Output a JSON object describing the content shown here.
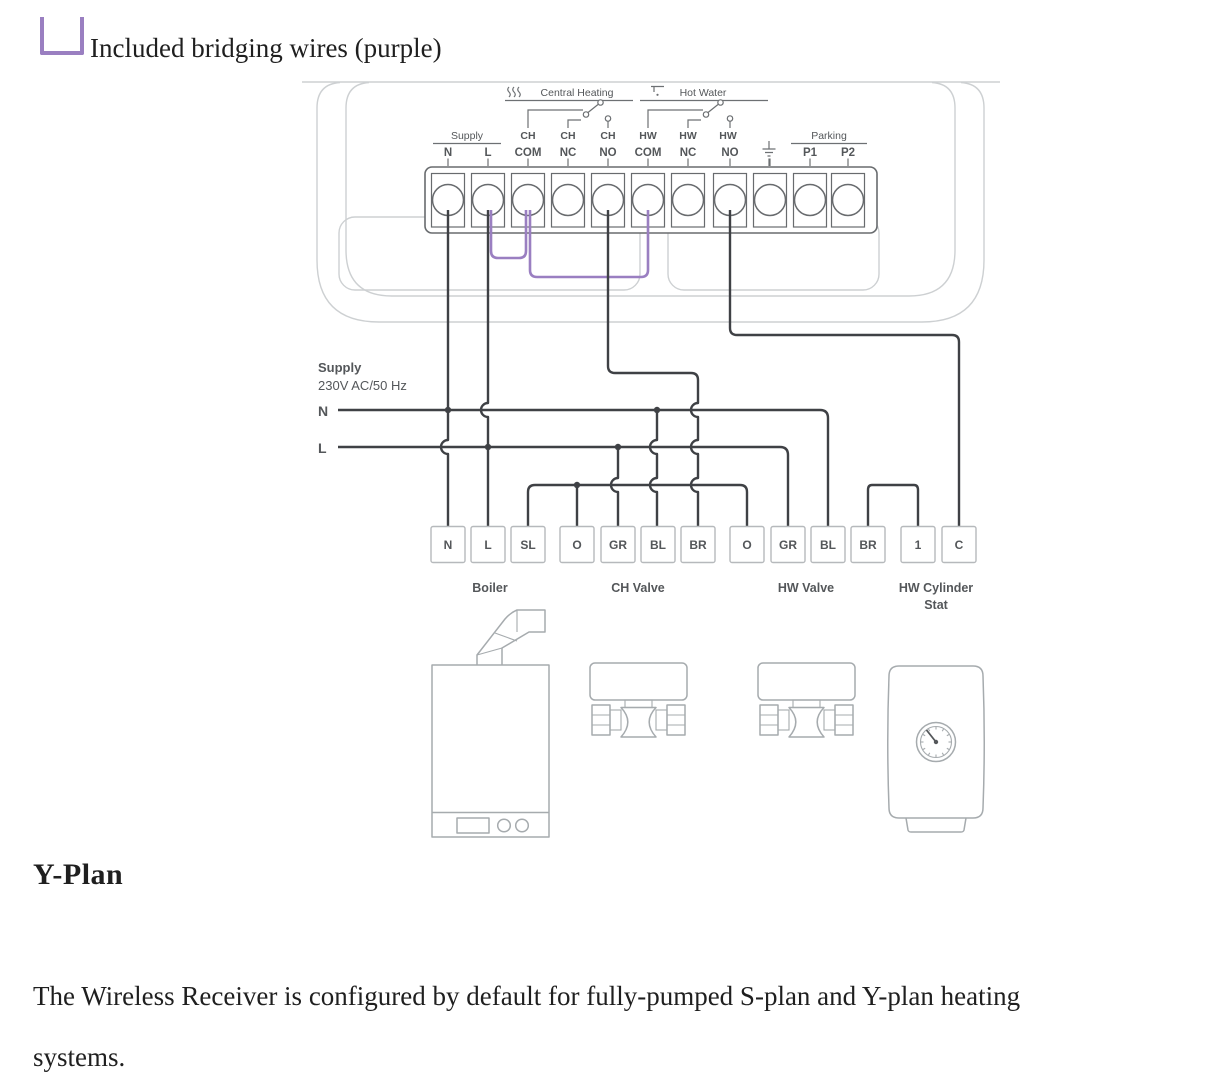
{
  "page": {
    "bridging_note": "Included bridging wires (purple)",
    "section_title": "Y-Plan",
    "body_lines": [
      "The Wireless Receiver is configured by default for fully-pumped S-plan and Y-plan heating",
      "systems."
    ]
  },
  "colors": {
    "bridging_purple": "#9a7fc1",
    "wire_dark": "#3f4145",
    "diagram_gray": "#a6abae"
  },
  "strip": {
    "groups": {
      "supply": "Supply",
      "central_heating": "Central Heating",
      "hot_water": "Hot Water",
      "parking": "Parking"
    },
    "row1": [
      "CH",
      "CH",
      "CH",
      "HW",
      "HW",
      "HW"
    ],
    "row2": [
      "N",
      "L",
      "COM",
      "NC",
      "NO",
      "COM",
      "NC",
      "NO",
      "P1",
      "P2"
    ]
  },
  "supply_note": {
    "title": "Supply",
    "subtitle": "230V AC/50 Hz",
    "n": "N",
    "l": "L"
  },
  "bottom_terminals": [
    "N",
    "L",
    "SL",
    "O",
    "GR",
    "BL",
    "BR",
    "O",
    "GR",
    "BL",
    "BR",
    "1",
    "C"
  ],
  "components": {
    "boiler": "Boiler",
    "ch_valve": "CH Valve",
    "hw_valve": "HW Valve",
    "cyl_stat": [
      "HW Cylinder",
      "Stat"
    ]
  }
}
